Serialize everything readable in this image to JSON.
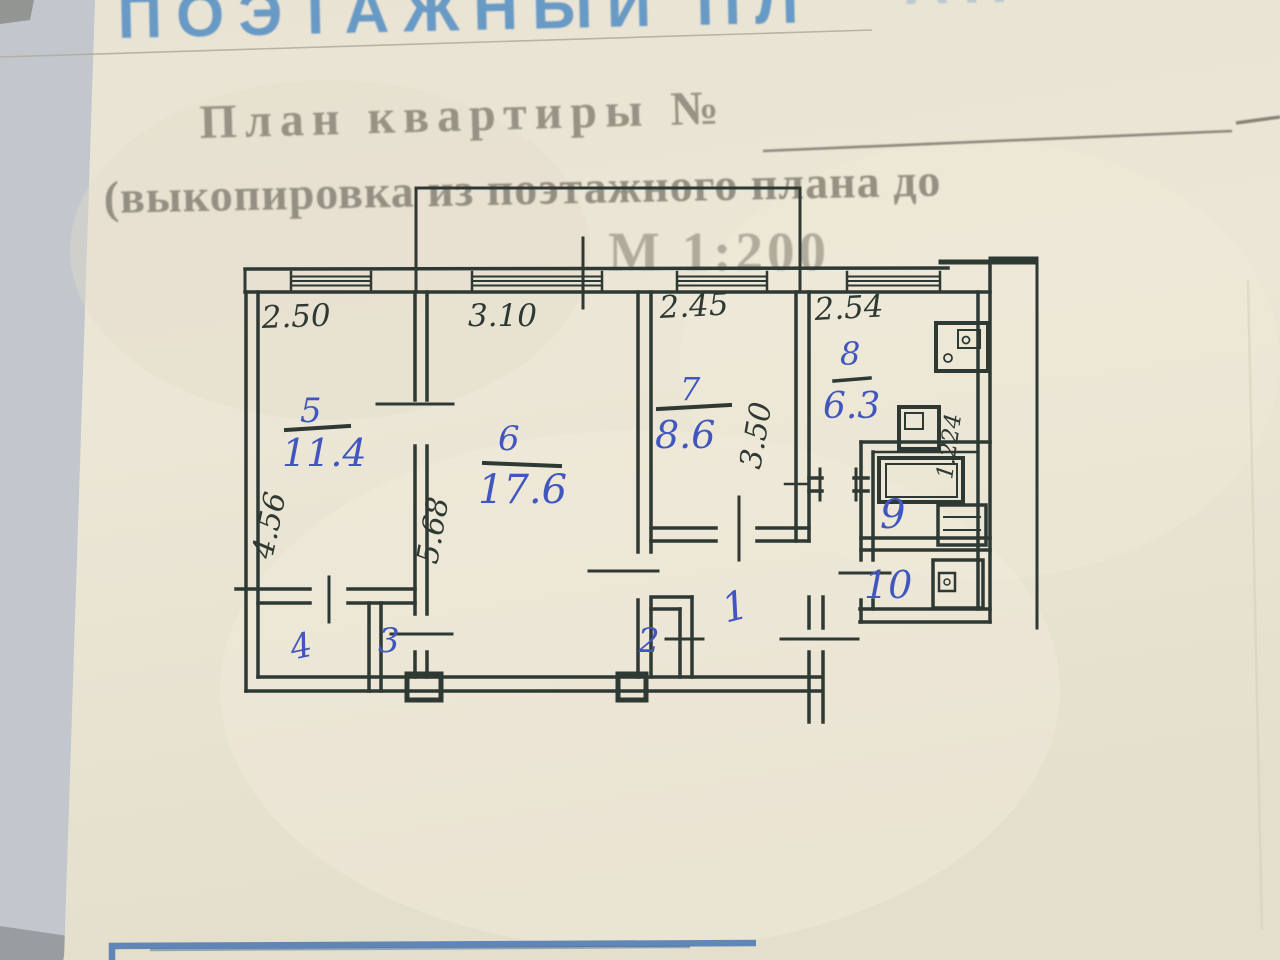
{
  "document": {
    "top_heading_partial": "ПОЭТАЖНЫЙ ПЛ",
    "top_heading_faint": "АН",
    "plan_title": "План квартиры №",
    "subtitle": "(выкопировка из поэтажного плана до",
    "scale": "М 1:200"
  },
  "floorplan": {
    "top_dimensions": [
      "2.50",
      "3.10",
      "2.45",
      "2.54"
    ],
    "vertical_dimensions": {
      "room5_left": "4.56",
      "room6_wall": "5.68",
      "room7_right": "3.50",
      "kitchen_right": "1.224"
    },
    "rooms": [
      {
        "number": "5",
        "area": "11.4"
      },
      {
        "number": "6",
        "area": "17.6"
      },
      {
        "number": "7",
        "area": "8.6"
      },
      {
        "number": "8",
        "area": "6.3"
      },
      {
        "number": "9"
      },
      {
        "number": "10"
      },
      {
        "number": "1"
      },
      {
        "number": "2"
      },
      {
        "number": "3"
      },
      {
        "number": "4"
      }
    ],
    "ink_color": "#2e3933",
    "pen_color": "#4156bf"
  }
}
